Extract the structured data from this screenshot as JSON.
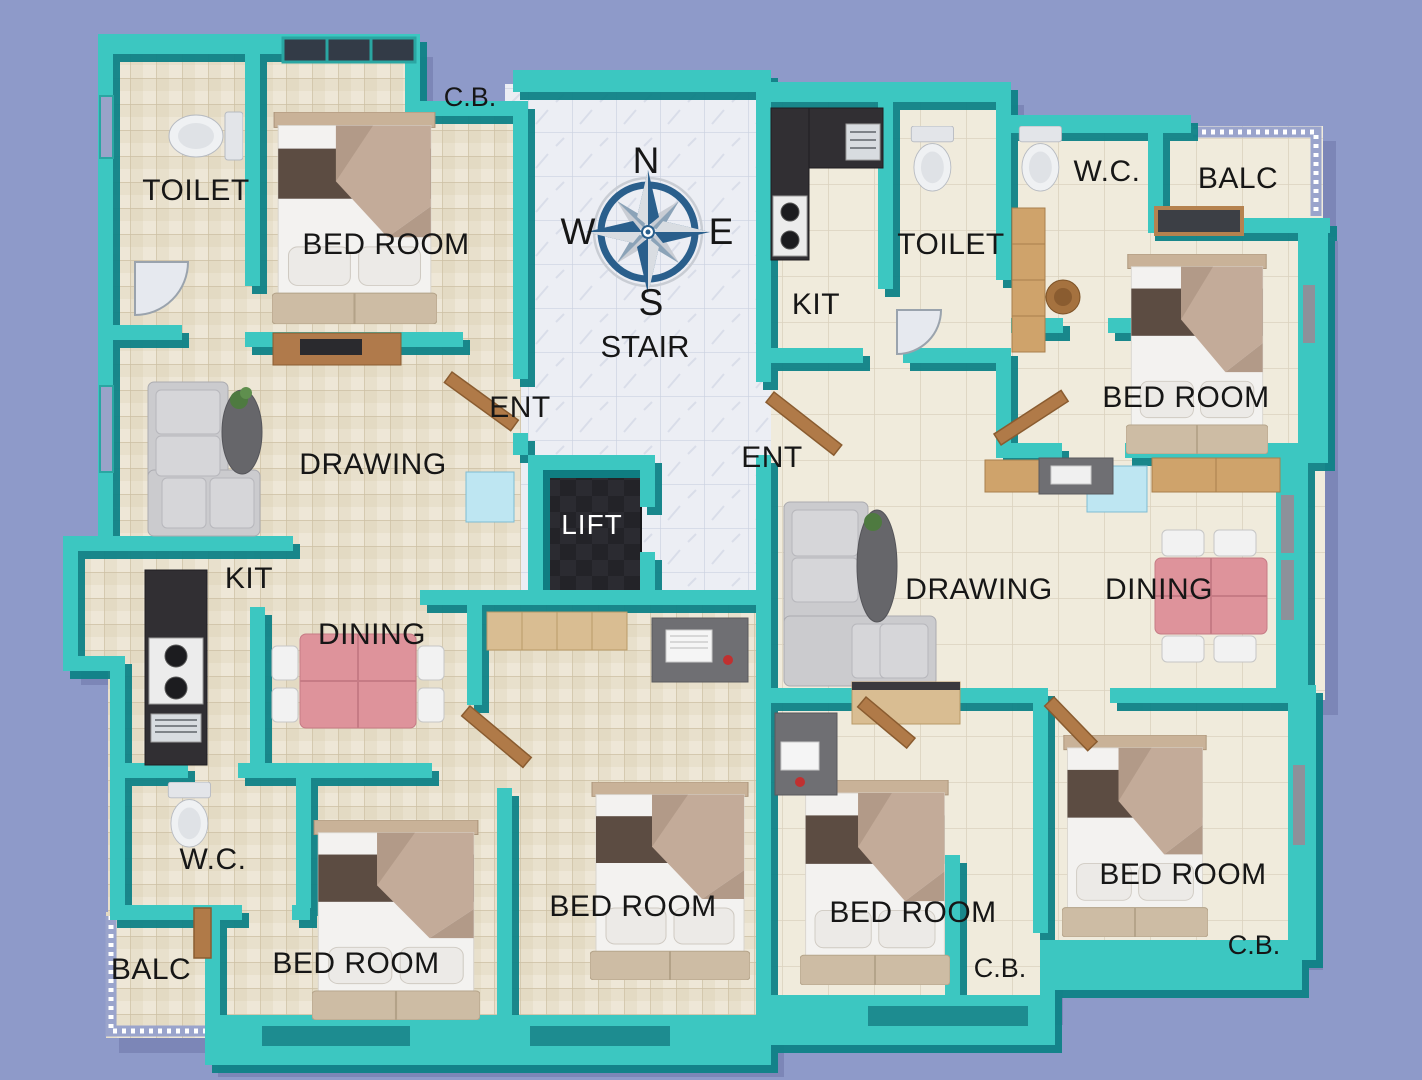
{
  "page": {
    "type": "3d-apartment-floor-plan",
    "units": 2
  },
  "colors": {
    "background": "#8E9AC9",
    "wall": "#3CC7C1",
    "wall_shadow": "#0E8287",
    "floor_left_unit": "#E8E0CC",
    "floor_right_unit": "#F0EBDC",
    "floor_stair_core": "#ECEEF4",
    "lift_floor": "#232328",
    "dining_table": "#DE939B",
    "compass_navy": "#2A5F8C",
    "wood": "#B07A48",
    "label_dark": "#161616",
    "label_light": "#FFFFFF"
  },
  "compass": {
    "n": "N",
    "w": "W",
    "e": "E",
    "s": "S"
  },
  "rooms": {
    "cb_top_left": "C.B.",
    "toilet_left": "TOILET",
    "bedroom_top_left": "BED ROOM",
    "stair": "STAIR",
    "ent_left": "ENT",
    "kit_right": "KIT",
    "toilet_right": "TOILET",
    "wc_right": "W.C.",
    "balc_right": "BALC",
    "bedroom_top_right": "BED ROOM",
    "ent_right": "ENT",
    "drawing_left": "DRAWING",
    "lift": "LIFT",
    "kit_left": "KIT",
    "drawing_right": "DRAWING",
    "dining_right": "DINING",
    "dining_left": "DINING",
    "wc_left": "W.C.",
    "balc_left": "BALC",
    "bedroom_bottom_left": "BED ROOM",
    "bedroom_bottom_middle": "BED ROOM",
    "bedroom_mid_right": "BED ROOM",
    "cb_bottom_middle": "C.B.",
    "bedroom_bottom_right": "BED ROOM",
    "cb_bottom_right": "C.B."
  }
}
